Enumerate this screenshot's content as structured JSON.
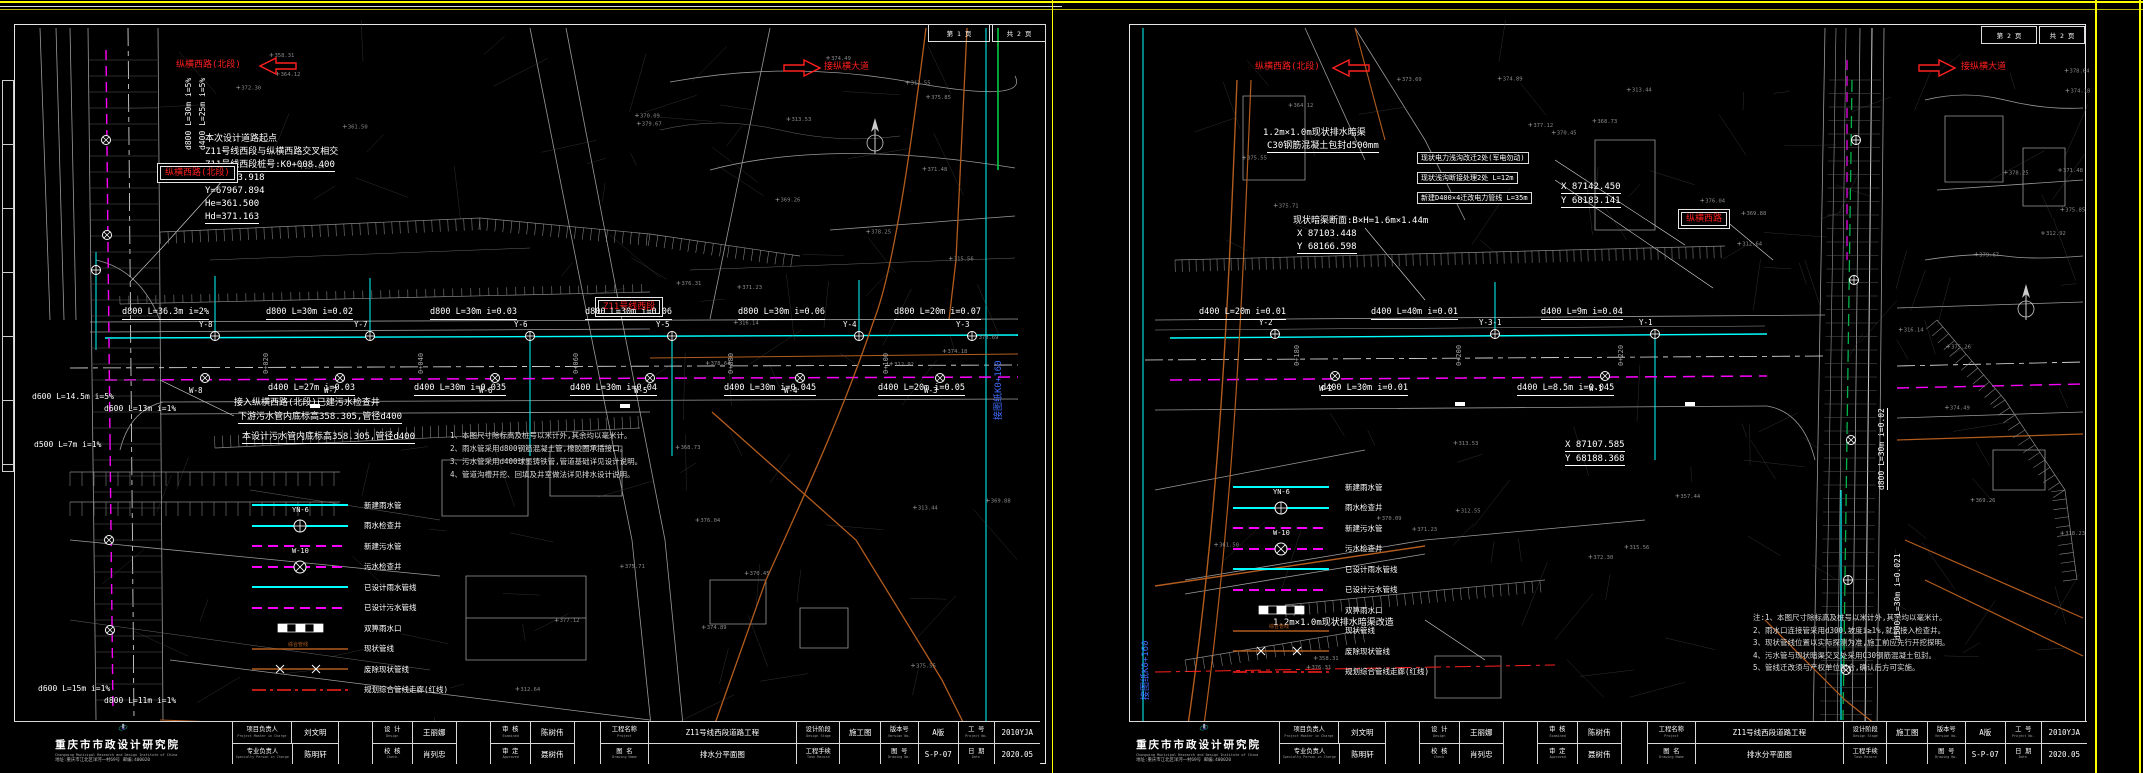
{
  "company": {
    "name": "重庆市市政设计研究院",
    "en": "Chongqing Municipal Research and Design Institute of China",
    "addr": "地址:重庆市江北区洋河一村69号  邮编:400020"
  },
  "title_block": {
    "row1": [
      {
        "label": "项目负责人",
        "en": "Project Master in Charge",
        "value": "刘文明"
      },
      {
        "label": "设  计",
        "en": "Design",
        "value": "王丽娜"
      },
      {
        "label": "审  核",
        "en": "Examined",
        "value": "陈树伟"
      },
      {
        "label": "工程名称",
        "en": "Project",
        "value": "Z11号线西段道路工程"
      },
      {
        "label": "设计阶段",
        "en": "Design Stage",
        "value": "施工图"
      },
      {
        "label": "版本号",
        "en": "Version No.",
        "value": "A版"
      },
      {
        "label": "工  号",
        "en": "Project No.",
        "value": "2010YJA"
      }
    ],
    "row2": [
      {
        "label": "专业负责人",
        "en": "Specialty Person in Charge",
        "value": "陈明轩"
      },
      {
        "label": "校  核",
        "en": "Check",
        "value": "肖列忠"
      },
      {
        "label": "审  定",
        "en": "Approved",
        "value": "聂树伟"
      },
      {
        "label": "图  名",
        "en": "Drawing Name",
        "value": "排水分平面图"
      },
      {
        "label": "工程手续",
        "en": "Task Record",
        "value": ""
      },
      {
        "label": "图  号",
        "en": "Drawing No.",
        "value": "S-P-07"
      },
      {
        "label": "日  期",
        "en": "Date",
        "value": "2020.05"
      }
    ]
  },
  "legend": {
    "rain_well_name": "YN-6",
    "sewage_well_name": "W-10",
    "items": [
      {
        "type": "rain-line",
        "label": "新建雨水管"
      },
      {
        "type": "rain-well",
        "label": "雨水检查井"
      },
      {
        "type": "sewage-line",
        "label": "新建污水管"
      },
      {
        "type": "sewage-well",
        "label": "污水检查井"
      },
      {
        "type": "designed-rain",
        "label": "已设计雨水管线"
      },
      {
        "type": "designed-sewage",
        "label": "已设计污水管线"
      },
      {
        "type": "inlet",
        "label": "双箅雨水口"
      },
      {
        "type": "existing",
        "label": "现状管线"
      },
      {
        "type": "abolished",
        "label": "废除现状管线"
      },
      {
        "type": "redline",
        "label": "规划综合管线走廊(红线)"
      }
    ]
  },
  "spot_elevations": [
    "379.67",
    "371.48",
    "369.26",
    "375.85",
    "378.25",
    "374.49",
    "376.31",
    "312.55",
    "313.53",
    "315.56",
    "370.09",
    "371.23",
    "372.30",
    "358.31",
    "361.50",
    "357.44",
    "364.12",
    "368.73",
    "375.55",
    "376.04",
    "312.64",
    "313.44",
    "374.89",
    "375.71",
    "370.45",
    "369.88",
    "377.12",
    "373.69",
    "312.92",
    "378.64",
    "374.18",
    "316.14",
    "318.23",
    "375.26"
  ],
  "sheets": [
    {
      "name": "left",
      "page_no": "第 1 页",
      "page_total": "共 2 页",
      "rain_wells": {
        "y": 316,
        "xs": [
          205,
          360,
          520,
          662,
          849,
          962
        ],
        "labels": [
          "Y-8",
          "Y-7",
          "Y-6",
          "Y-5",
          "Y-4",
          "Y-3"
        ]
      },
      "sewage_wells": {
        "y": 358,
        "xs": [
          195,
          330,
          485,
          640,
          790,
          930
        ],
        "labels": [
          "W-8",
          "W-7",
          "W-6",
          "W-5",
          "W-4",
          "W-3"
        ]
      },
      "labels": [
        {
          "t": "本次设计道路起点",
          "x": 195,
          "y": 114
        },
        {
          "t": "Z11号线西段与纵横西路交叉相交",
          "x": 195,
          "y": 127
        },
        {
          "t": "Z11号线西段桩号:K0+008.400",
          "x": 195,
          "y": 140,
          "u": 1
        },
        {
          "t": "X=87123.918",
          "x": 195,
          "y": 153
        },
        {
          "t": "Y=67967.894",
          "x": 195,
          "y": 166
        },
        {
          "t": "He=361.500",
          "x": 195,
          "y": 179
        },
        {
          "t": "Hd=371.163",
          "x": 195,
          "y": 192,
          "u": 1
        },
        {
          "t": "接入纵横西路(北段)已建污水检查井",
          "x": 224,
          "y": 378
        },
        {
          "t": "下游污水管内底标高358.305,管径d400",
          "x": 228,
          "y": 392,
          "u": 1
        },
        {
          "t": "本设计污水管内底标高358.305,管径d400",
          "x": 232,
          "y": 412,
          "u": 1
        },
        {
          "t": "纵横西路(北段)",
          "x": 166,
          "y": 40,
          "c": "red"
        },
        {
          "t": "接纵横大道",
          "x": 814,
          "y": 42,
          "c": "red"
        },
        {
          "t": "纵横西路(北段)",
          "x": 150,
          "y": 146,
          "c": "red",
          "b": 1
        },
        {
          "t": "Z11号线西段",
          "x": 588,
          "y": 280,
          "c": "red",
          "b": 1
        },
        {
          "t": "接图纸K0+160",
          "x": 984,
          "y": 400,
          "c": "blue",
          "r": -90
        },
        {
          "t": "d800 L=30m i=5%",
          "x": 174,
          "y": 130,
          "r": -90,
          "s": 8
        },
        {
          "t": "d400 L=25m i=5%",
          "x": 188,
          "y": 130,
          "r": -90,
          "s": 8
        },
        {
          "t": "0+020",
          "x": 252,
          "y": 354,
          "r": -90,
          "s": 7,
          "c": "gray"
        },
        {
          "t": "0+040",
          "x": 407,
          "y": 354,
          "r": -90,
          "s": 7,
          "c": "gray"
        },
        {
          "t": "0+060",
          "x": 562,
          "y": 354,
          "r": -90,
          "s": 7,
          "c": "gray"
        },
        {
          "t": "0+080",
          "x": 717,
          "y": 354,
          "r": -90,
          "s": 7,
          "c": "gray"
        },
        {
          "t": "0+100",
          "x": 872,
          "y": 354,
          "r": -90,
          "s": 7,
          "c": "gray"
        },
        {
          "t": "d800 L=36.3m i=2%",
          "x": 112,
          "y": 288,
          "u": 1,
          "s": 8.5
        },
        {
          "t": "d800 L=30m i=0.02",
          "x": 256,
          "y": 288,
          "u": 1,
          "s": 8.5
        },
        {
          "t": "d800 L=30m i=0.03",
          "x": 420,
          "y": 288,
          "u": 1,
          "s": 8.5
        },
        {
          "t": "d800 L=30m i=0.06",
          "x": 575,
          "y": 288,
          "u": 1,
          "s": 8.5
        },
        {
          "t": "d800 L=30m i=0.06",
          "x": 728,
          "y": 288,
          "u": 1,
          "s": 8.5
        },
        {
          "t": "d800 L=20m i=0.07",
          "x": 884,
          "y": 288,
          "u": 1,
          "s": 8.5
        },
        {
          "t": "d400 L=27m i=0.03",
          "x": 258,
          "y": 364,
          "u": 1,
          "s": 8.5
        },
        {
          "t": "d400 L=30m i=0.035",
          "x": 404,
          "y": 364,
          "u": 1,
          "s": 8.5
        },
        {
          "t": "d400 L=30m i=0.04",
          "x": 560,
          "y": 364,
          "u": 1,
          "s": 8.5
        },
        {
          "t": "d400 L=30m i=0.045",
          "x": 714,
          "y": 364,
          "u": 1,
          "s": 8.5
        },
        {
          "t": "d400 L=20m i=0.05",
          "x": 868,
          "y": 364,
          "u": 1,
          "s": 8.5
        },
        {
          "t": "d600 L=14.5m i=5%",
          "x": 22,
          "y": 372,
          "s": 8
        },
        {
          "t": "d600 L=13m i=1%",
          "x": 94,
          "y": 384,
          "s": 8
        },
        {
          "t": "d500 L=7m i=1%",
          "x": 24,
          "y": 420,
          "s": 8
        },
        {
          "t": "d600 L=15m i=1%",
          "x": 28,
          "y": 664,
          "s": 8
        },
        {
          "t": "d800 L=11m i=1%",
          "x": 94,
          "y": 676,
          "s": 8
        }
      ],
      "notes": {
        "x": 440,
        "y": 410,
        "step": 13,
        "lines": [
          "1、本图尺寸除标高及桩号以米计外,其余均以毫米计。",
          "2、雨水管采用d800钢筋混凝土管,橡胶圈承插接口。",
          "3、污水管采用d400球墨铸铁管,管道基础详见设计说明。",
          "4、管道沟槽开挖、回填及井室做法详见排水设计说明。"
        ]
      },
      "legend_pos": {
        "x": 240,
        "y": 474
      }
    },
    {
      "name": "right",
      "page_no": "第 2 页",
      "page_total": "共 2 页",
      "rain_wells": {
        "y": 314,
        "xs": [
          150,
          370,
          530
        ],
        "labels": [
          "Y-2",
          "Y-3-1",
          "Y-1"
        ]
      },
      "sewage_wells": {
        "y": 356,
        "xs": [
          210,
          480
        ],
        "labels": [
          "W-2",
          "W-1"
        ]
      },
      "labels": [
        {
          "t": "纵横西路(北段)",
          "x": 130,
          "y": 42,
          "c": "red"
        },
        {
          "t": "接纵横大道",
          "x": 836,
          "y": 42,
          "c": "red"
        },
        {
          "t": "纵横西路",
          "x": 556,
          "y": 192,
          "c": "red",
          "b": 1
        },
        {
          "t": "现状电力浅沟改迁2处(军电勿动)",
          "x": 292,
          "y": 132,
          "b": 2
        },
        {
          "t": "现状浅沟断接处理2处 L=12m",
          "x": 292,
          "y": 152,
          "b": 2
        },
        {
          "t": "新建D400×4迁改电力管线 L=35m",
          "x": 292,
          "y": 172,
          "b": 2
        },
        {
          "t": "X 87142.450",
          "x": 436,
          "y": 162,
          "u": 1
        },
        {
          "t": "Y 68183.141",
          "x": 436,
          "y": 176,
          "u": 1
        },
        {
          "t": "X 87107.585",
          "x": 440,
          "y": 420,
          "u": 1
        },
        {
          "t": "Y 68188.368",
          "x": 440,
          "y": 434,
          "u": 1
        },
        {
          "t": "1.2m×1.0m现状排水暗渠",
          "x": 138,
          "y": 108
        },
        {
          "t": "C30钢筋混凝土包封d500mm",
          "x": 142,
          "y": 121,
          "u": 1
        },
        {
          "t": "现状暗渠断面:B×H=1.6m×1.44m",
          "x": 168,
          "y": 196
        },
        {
          "t": "X 87103.448",
          "x": 172,
          "y": 209
        },
        {
          "t": "Y 68166.598",
          "x": 172,
          "y": 222,
          "u": 1
        },
        {
          "t": "1.2m×1.0m现状排水暗渠改造",
          "x": 148,
          "y": 598
        },
        {
          "t": "接图纸K0+160",
          "x": 16,
          "y": 680,
          "c": "blue",
          "r": -90
        },
        {
          "t": "d800 L=30m i=0.02",
          "x": 752,
          "y": 470,
          "r": -90,
          "s": 8,
          "u": 1
        },
        {
          "t": "d500 L=30m i=0.021",
          "x": 768,
          "y": 620,
          "r": -90,
          "s": 8
        },
        {
          "t": "0+180",
          "x": 168,
          "y": 346,
          "r": -90,
          "s": 7,
          "c": "gray"
        },
        {
          "t": "0+200",
          "x": 330,
          "y": 346,
          "r": -90,
          "s": 7,
          "c": "gray"
        },
        {
          "t": "0+220",
          "x": 492,
          "y": 346,
          "r": -90,
          "s": 7,
          "c": "gray"
        },
        {
          "t": "d400 L=20m i=0.01",
          "x": 74,
          "y": 288,
          "u": 1,
          "s": 8.5
        },
        {
          "t": "d400 L=40m i=0.01",
          "x": 246,
          "y": 288,
          "u": 1,
          "s": 8.5
        },
        {
          "t": "d400 L=9m i=0.04",
          "x": 416,
          "y": 288,
          "u": 1,
          "s": 8.5
        },
        {
          "t": "d400 L=30m i=0.01",
          "x": 196,
          "y": 364,
          "u": 1,
          "s": 8.5
        },
        {
          "t": "d400 L=8.5m i=0.045",
          "x": 392,
          "y": 364,
          "u": 1,
          "s": 8.5
        }
      ],
      "notes": {
        "x": 628,
        "y": 592,
        "step": 12.5,
        "lines": [
          "注:1、本图尺寸除标高及桩号以米计外,其余均以毫米计。",
          "2、雨水口连接管采用d300,坡度i≥1%,就近接入检查井。",
          "3、现状管线位置以实际探测为准,施工前应先行开挖探明。",
          "4、污水管与现状暗渠交叉处采用C30钢筋混凝土包封。",
          "5、管线迁改须与产权单位配合,确认后方可实施。"
        ]
      },
      "legend_pos": {
        "x": 106,
        "y": 456
      }
    }
  ]
}
